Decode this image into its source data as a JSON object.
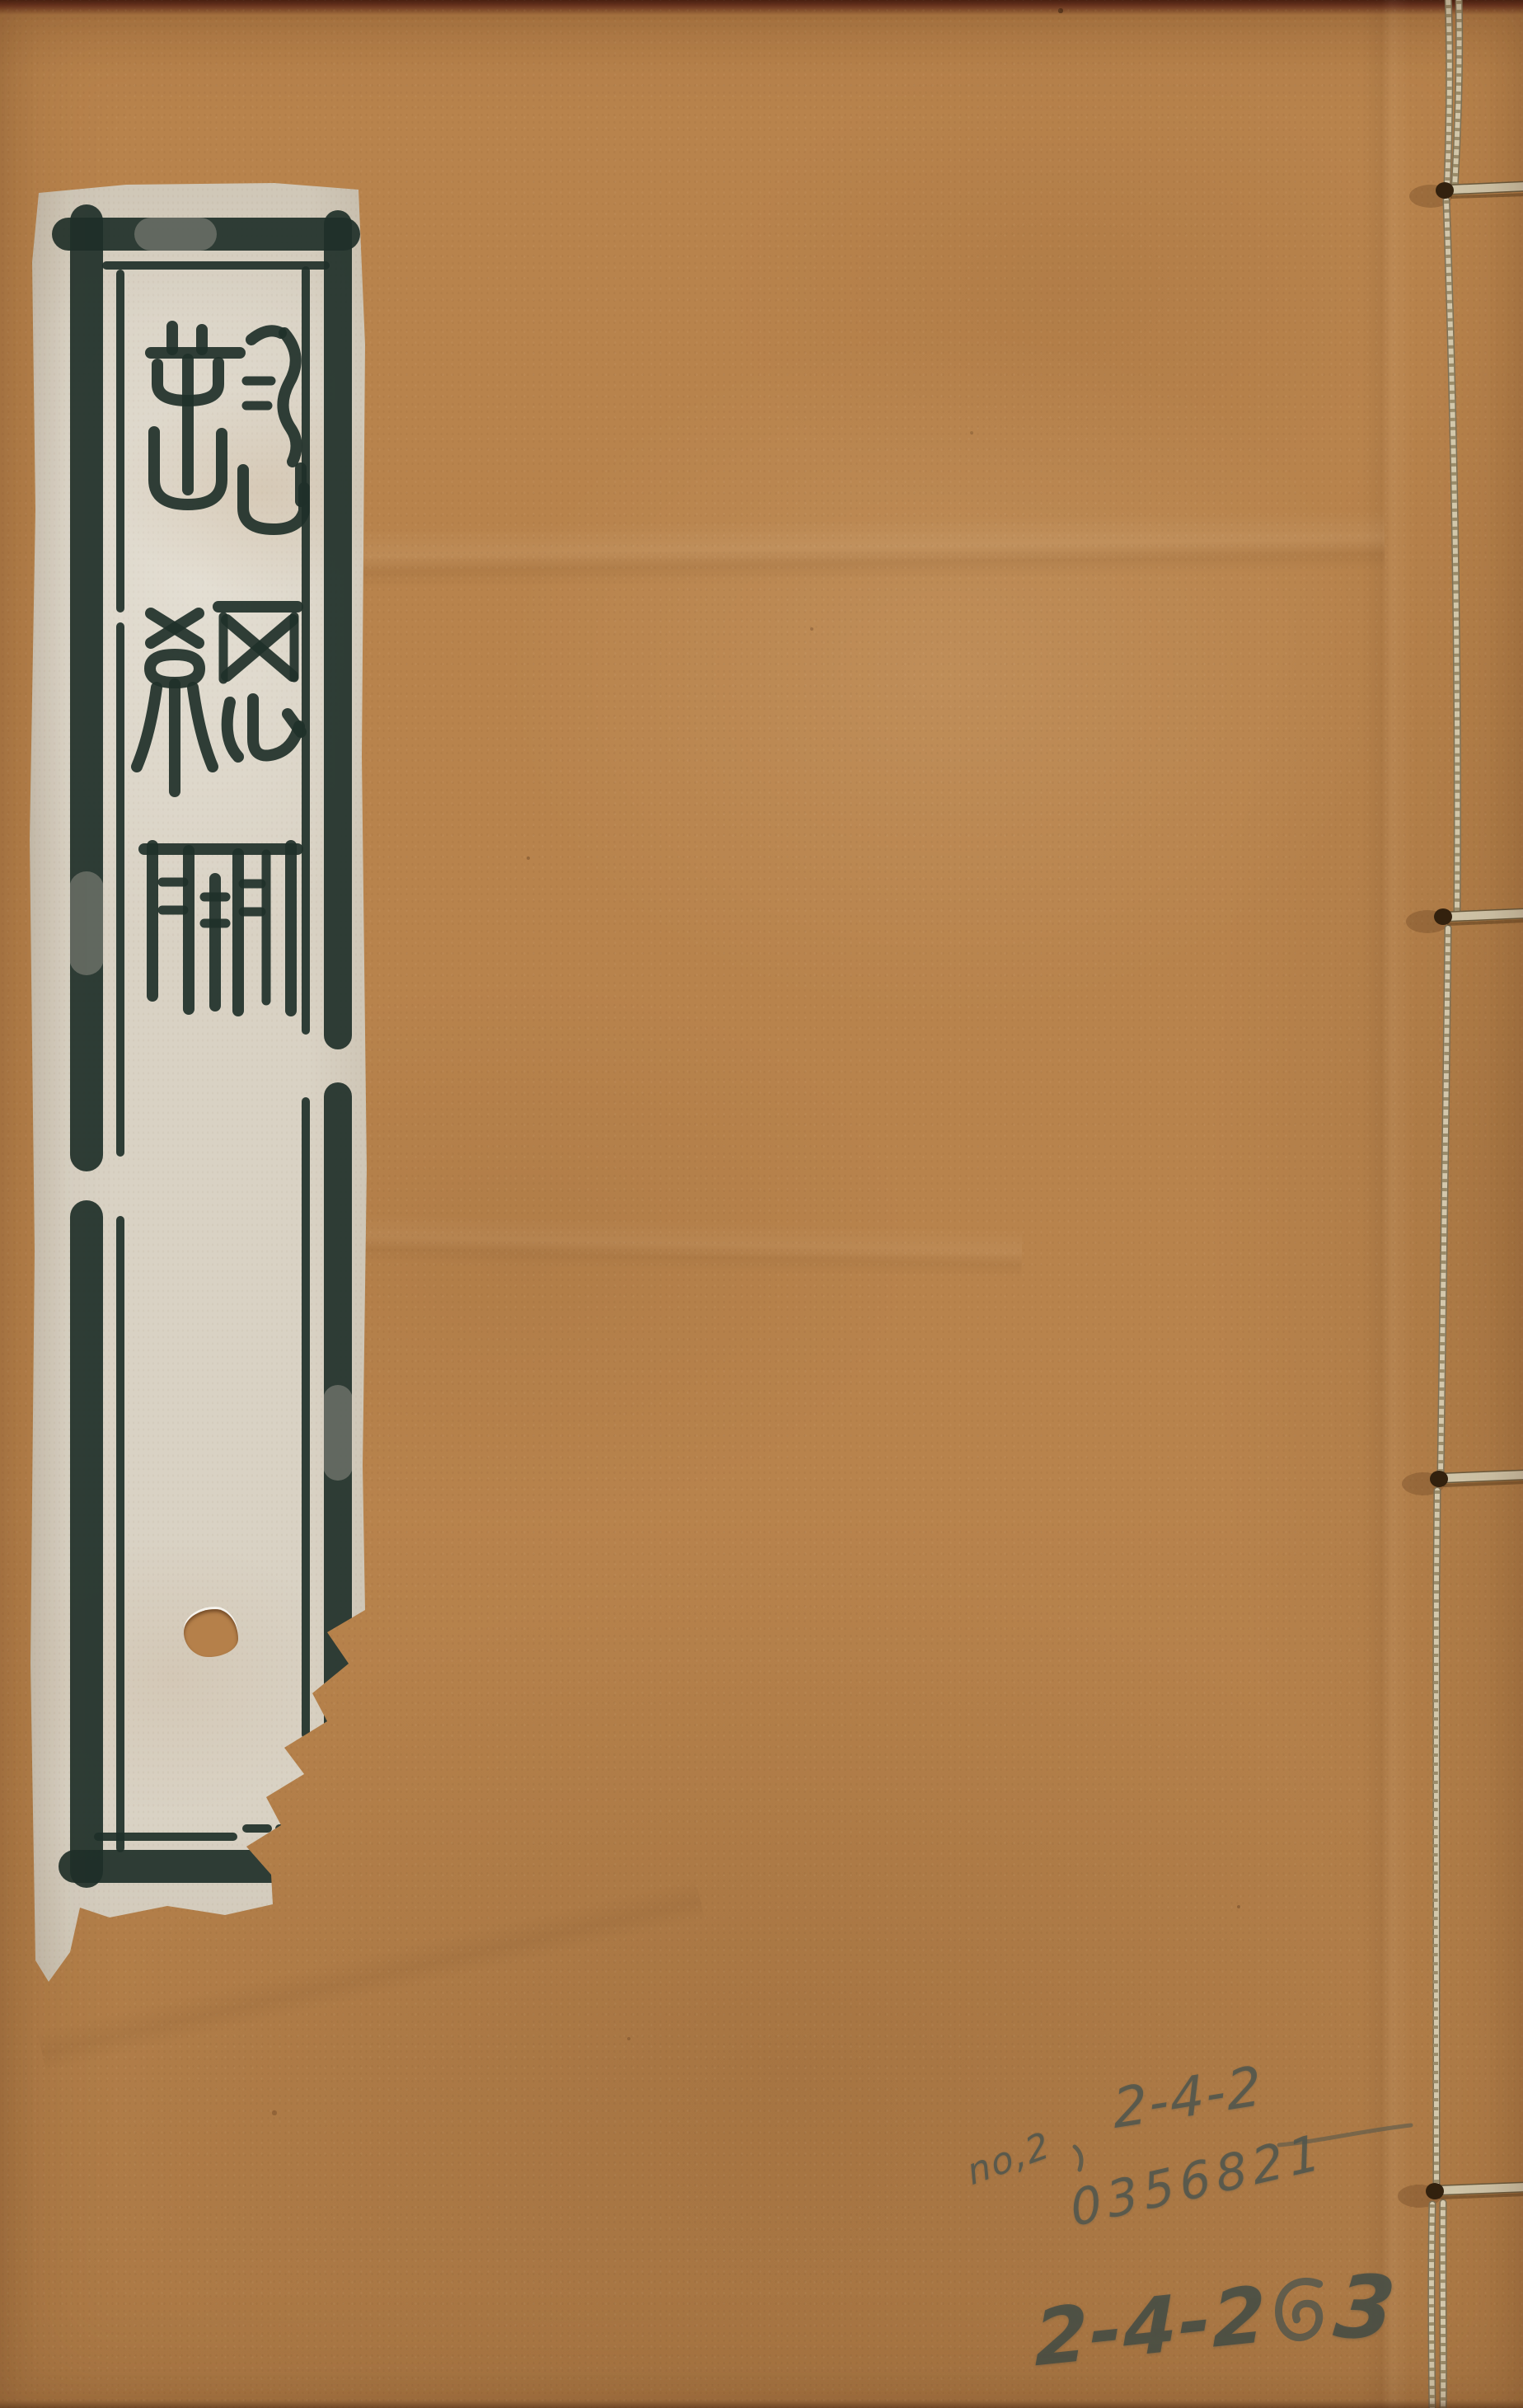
{
  "artifact": {
    "kind": "thread-bound book front cover",
    "cover_color": "#b8834c",
    "label_paper_color": "#d9d2c4",
    "ink_color": "#203029",
    "thread_color": "#d6cbaf",
    "pencil_color": "#50564e",
    "top_edge_color": "#6b3320"
  },
  "title_label": {
    "full_title": "詩總聞",
    "script": "seal script, vertical top-to-bottom",
    "characters": [
      "詩",
      "總",
      "聞"
    ]
  },
  "pencil_annotations": {
    "line1_prefix": "no,2",
    "line1_pause_mark": "、",
    "line1_number": "2-4-2",
    "line2_number": "0356821",
    "line3_start": "2-4-2",
    "line3_separator": "の",
    "line3_end": "3",
    "line3_full": "2-4-2の3"
  },
  "binding": {
    "visible_holes": 4,
    "stitch_style": "four-hole thread binding"
  }
}
